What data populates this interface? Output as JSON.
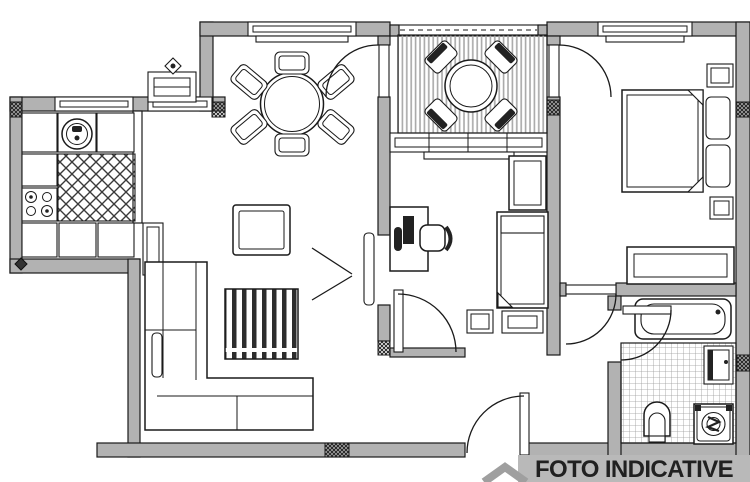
{
  "label": {
    "text": "FOTO INDICATIVE"
  },
  "colors": {
    "background": "#ffffff",
    "wall_fill": "#b2b2b2",
    "line": "#1a1a1a",
    "window_fill": "#ffffff",
    "furniture_fill": "#ffffff",
    "dark_accent": "#222222",
    "label_bar": "#b9b9b9",
    "label_text": "#212121",
    "logo_gray": "#9f9f9f",
    "tile_line": "#9a9a9a",
    "deck_line": "#a8a8a8"
  },
  "plan": {
    "type": "apartment-floor-plan",
    "door_count": 7,
    "window_count": 5,
    "rooms": [
      {
        "name": "kitchen",
        "furniture": [
          "sink",
          "stove-4-burner",
          "lattice-counter",
          "cabinets",
          "tall-cabinet",
          "radiator"
        ]
      },
      {
        "name": "dining-area",
        "furniture": [
          "round-table",
          "six-chairs",
          "window"
        ]
      },
      {
        "name": "living-area",
        "furniture": [
          "l-shaped-sofa",
          "striped-rug",
          "tv-table",
          "double-swing-door"
        ]
      },
      {
        "name": "balcony",
        "furniture": [
          "decking",
          "round-table",
          "four-chairs",
          "railing",
          "glazed-window"
        ]
      },
      {
        "name": "bedroom",
        "furniture": [
          "double-bed",
          "two-pillows",
          "two-nightstands",
          "dresser",
          "window",
          "balcony-door"
        ]
      },
      {
        "name": "study-bedroom",
        "furniture": [
          "desk",
          "monitor",
          "office-chair",
          "wardrobe",
          "single-bed",
          "nightstand",
          "side-table"
        ]
      },
      {
        "name": "bathroom",
        "furniture": [
          "bathtub",
          "toilet",
          "washing-machine",
          "vanity-sink",
          "tiled-floor"
        ]
      },
      {
        "name": "hallway",
        "furniture": [
          "entrance-door"
        ]
      }
    ]
  }
}
